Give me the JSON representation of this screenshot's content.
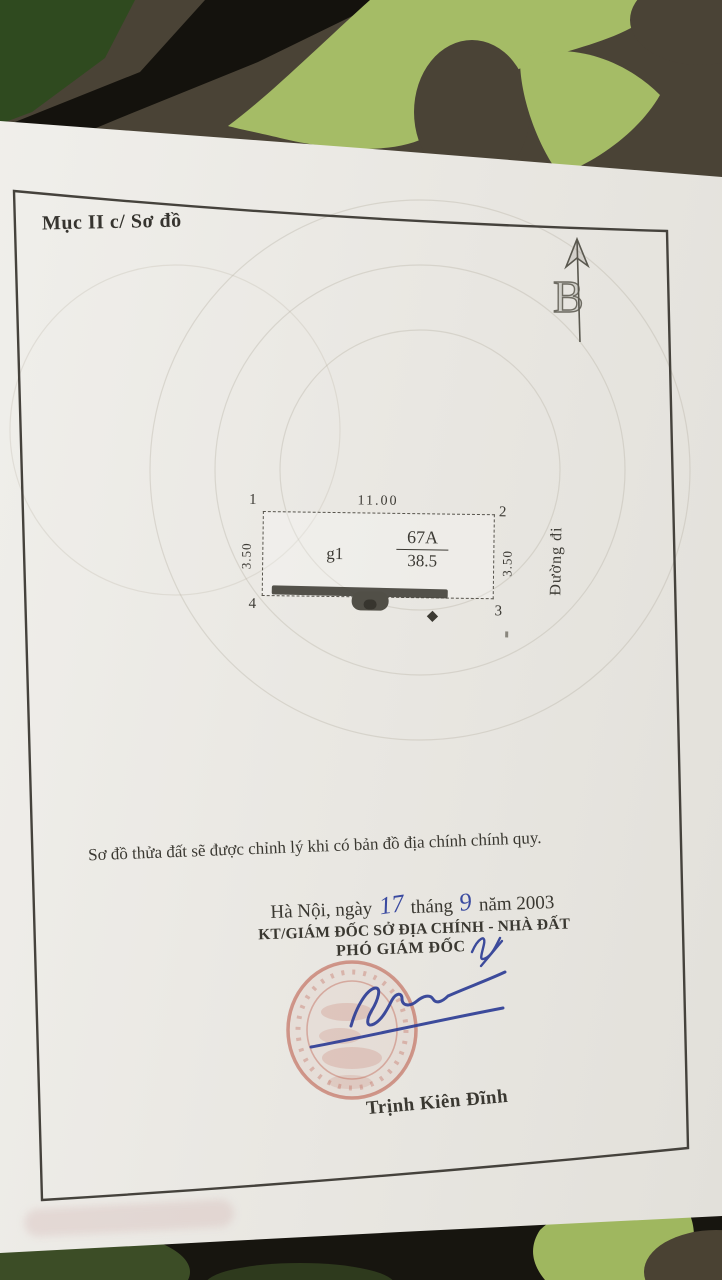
{
  "document": {
    "section_label": "Mục II c/ Sơ đồ",
    "compass_letter": "B",
    "plot": {
      "corners": [
        "1",
        "2",
        "3",
        "4"
      ],
      "width_label": "11.00",
      "left_side_label": "3.50",
      "right_side_label": "3.50",
      "zone_label": "g1",
      "parcel_id": "67A",
      "area": "38.5",
      "road_label": "Đường đi"
    },
    "note": "Sơ đồ thửa đất sẽ được chỉnh lý khi có bản đồ địa chính chính quy.",
    "issue": {
      "place_date_prefix": "Hà Nội, ngày",
      "day": "17",
      "month_word": "tháng",
      "month": "9",
      "year_word": "năm",
      "year": "2003",
      "authority_line": "KT/GIÁM ĐỐC SỞ ĐỊA CHÍNH - NHÀ ĐẤT",
      "signer_title": "PHÓ GIÁM ĐỐC",
      "signer_name": "Trịnh Kiên Đĩnh"
    },
    "colors": {
      "ink_blue": "#2e3e96",
      "stamp_red": "#ba5442",
      "paper": "#ebe9e4",
      "text": "#3a3831",
      "camo_brown": "#4a4336",
      "camo_black": "#17150f",
      "camo_dark_green": "#2f4a1f",
      "camo_light_green": "#a5bc66"
    }
  }
}
